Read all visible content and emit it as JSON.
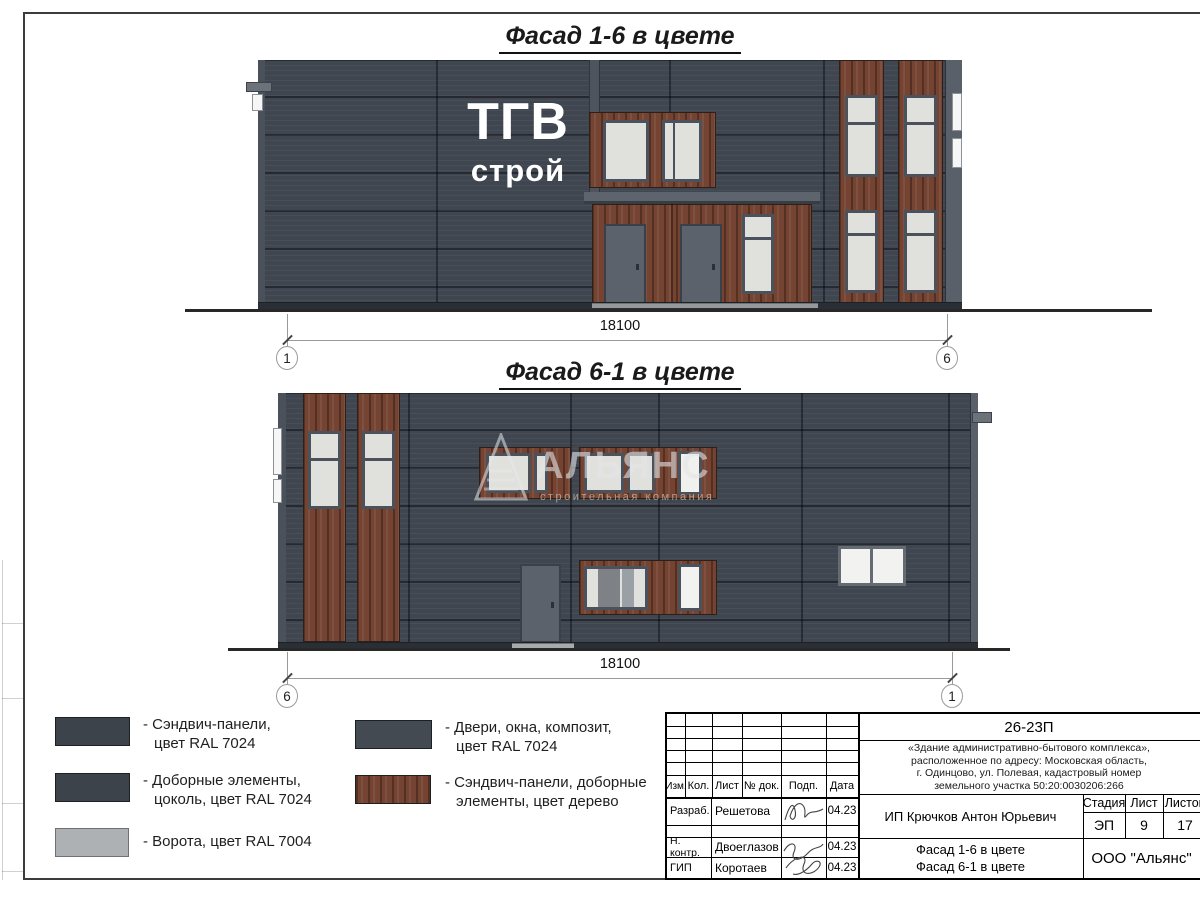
{
  "sheet": {
    "doc_number": "26-23П",
    "description_lines": [
      "«Здание административно-бытового комплекса»,",
      "расположенное по адресу: Московская область,",
      "г. Одинцово, ул. Полевая, кадастровый номер",
      "земельного участка 50:20:0030206:266"
    ]
  },
  "facade1": {
    "title": "Фасад 1-6 в цвете",
    "logo_line1": "ТГВ",
    "logo_line2": "строй",
    "dimension": "18100",
    "axis_left": "1",
    "axis_right": "6"
  },
  "facade2": {
    "title": "Фасад 6-1 в цвете",
    "watermark_name": "АЛЬЯНС",
    "watermark_subtitle": "строительная компания",
    "dimension": "18100",
    "axis_left": "6",
    "axis_right": "1"
  },
  "legend": {
    "items": [
      {
        "line1": "- Сэндвич-панели,",
        "line2": "цвет RAL 7024",
        "color": "#3d434b",
        "style": "flat"
      },
      {
        "line1": "- Доборные элементы,",
        "line2": "цоколь, цвет RAL 7024",
        "color": "#3d434b",
        "style": "flat"
      },
      {
        "line1": "- Ворота, цвет RAL 7004",
        "line2": "",
        "color": "#aeb1b3",
        "style": "flat"
      },
      {
        "line1": "- Двери, окна, композит,",
        "line2": "цвет RAL 7024",
        "color": "#434a52",
        "style": "flat"
      },
      {
        "line1": "- Сэндвич-панели, доборные",
        "line2": "элементы, цвет дерево",
        "color": "#744331",
        "style": "wood"
      }
    ]
  },
  "titleblock": {
    "columns": [
      "Изм.",
      "Кол.",
      "Лист",
      "№ док.",
      "Подп.",
      "Дата"
    ],
    "rows": [
      {
        "role": "Разраб.",
        "name": "Решетова",
        "date": "04.23"
      },
      {
        "role": "Н. контр.",
        "name": "Двоеглазов",
        "date": "04.23"
      },
      {
        "role": "ГИП",
        "name": "Коротаев",
        "date": "04.23"
      }
    ],
    "client": "ИП Крючков Антон Юрьевич",
    "stage_label": "Стадия",
    "sheet_label": "Лист",
    "sheets_label": "Листов",
    "stage": "ЭП",
    "sheet": "9",
    "sheets": "17",
    "object_line1": "Фасад 1-6 в цвете",
    "object_line2": "Фасад 6-1 в цвете",
    "company": "ООО \"Альянс\""
  },
  "colors": {
    "facade_gray": "#3f4650",
    "plinth_gray": "#2a2f36",
    "wood_brown": "#744331",
    "window_glass": "#e0e0dd",
    "frame_gray": "#4c525b",
    "door_gray": "#5b626c",
    "gate_gray": "#aeb1b3"
  }
}
